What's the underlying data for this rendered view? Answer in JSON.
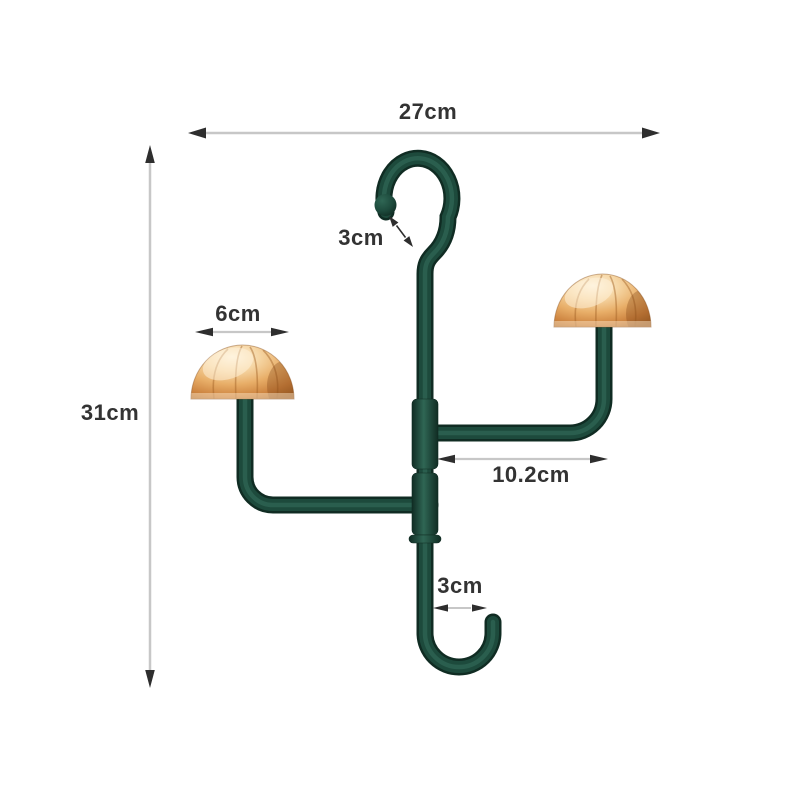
{
  "meta": {
    "type": "product-dimension-diagram",
    "subject": "double-ended hook hanger with two gold mushroom-cap pegs"
  },
  "annotations": {
    "width_label": "27cm",
    "height_label": "31cm",
    "top_hook_label": "3cm",
    "cap_width_label": "6cm",
    "arm_length_label": "10.2cm",
    "bottom_hook_label": "3cm"
  },
  "colors": {
    "background": "#ffffff",
    "tube_dark": "#102c23",
    "tube_mid": "#1d4a3c",
    "tube_highlight": "#2f6654",
    "cap_highlight": "#fdf3de",
    "cap_light": "#f6d7a6",
    "cap_mid": "#e8ae68",
    "cap_deep": "#cd8440",
    "cap_shadow": "#a5652a",
    "dim_line": "#c7c7c7",
    "dim_arrow": "#2e2e2e",
    "dim_text": "#333333"
  }
}
